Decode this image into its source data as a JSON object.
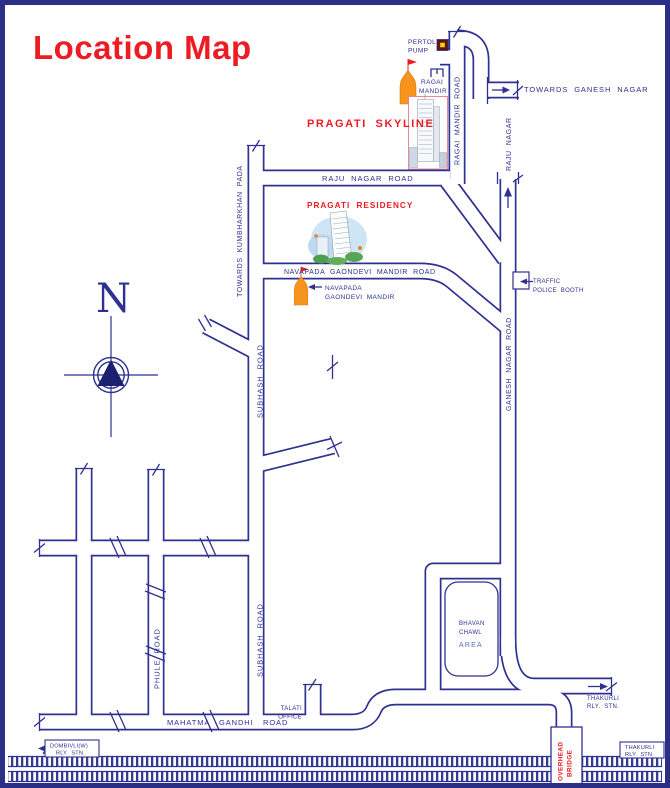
{
  "title": "Location Map",
  "colors": {
    "ink": "#2e3192",
    "red": "#ed1c24",
    "area_blue": "#5b6cb8",
    "temple_orange": "#f7941d",
    "rail": "#353b90"
  },
  "compass": {
    "north": "N"
  },
  "roads": {
    "ragai_mandir_road": "RAGAI MANDIR ROAD",
    "raju_nagar_road": "RAJU NAGAR ROAD",
    "raju_nagar": "RAJU NAGAR",
    "towards_ganesh_nagar": "TOWARDS GANESH NAGAR",
    "towards_kumbharkhan_pada": "TOWARDS KUMBHARKHAN PADA",
    "navapada_gaondevi_mandir_road": "NAVAPADA GAONDEVI MANDIR ROAD",
    "ganesh_nagar_road": "GANESH NAGAR ROAD",
    "subhash_road": "SUBHASH ROAD",
    "phule_road": "PHULE ROAD",
    "mahatma_gandhi_road": [
      "MAHATMA",
      "GANDHI",
      "ROAD"
    ]
  },
  "landmarks": {
    "pragati_skyline": "PRAGATI SKYLINE",
    "pragati_residency": "PRAGATI RESIDENCY",
    "pertol_pump": [
      "PERTOL",
      "PUMP"
    ],
    "ragai_mandir": [
      "RAGAI",
      "MANDIR"
    ],
    "navapada_gaondevi_mandir": [
      "NAVAPADA",
      "GAONDEVI MANDIR"
    ],
    "traffic_police_booth": [
      "TRAFFIC",
      "POLICE BOOTH"
    ],
    "bhavan_chawl_area": [
      "BHAVAN",
      "CHAWL",
      "AREA"
    ],
    "talati_office": [
      "TALATI",
      "OFFICE"
    ],
    "overhead_bridge": [
      "OVERHEAD",
      "BRIDGE"
    ]
  },
  "stations": {
    "thakurli_rly_stn_pointer": [
      "THAKURLI",
      "RLY. STN."
    ],
    "thakurli_rly_stn_box": [
      "THAKURLI",
      "RLY. STN."
    ],
    "dombivli_rly_stn_box": [
      "DOMBIVLI(W)",
      "RLY. STN."
    ]
  }
}
